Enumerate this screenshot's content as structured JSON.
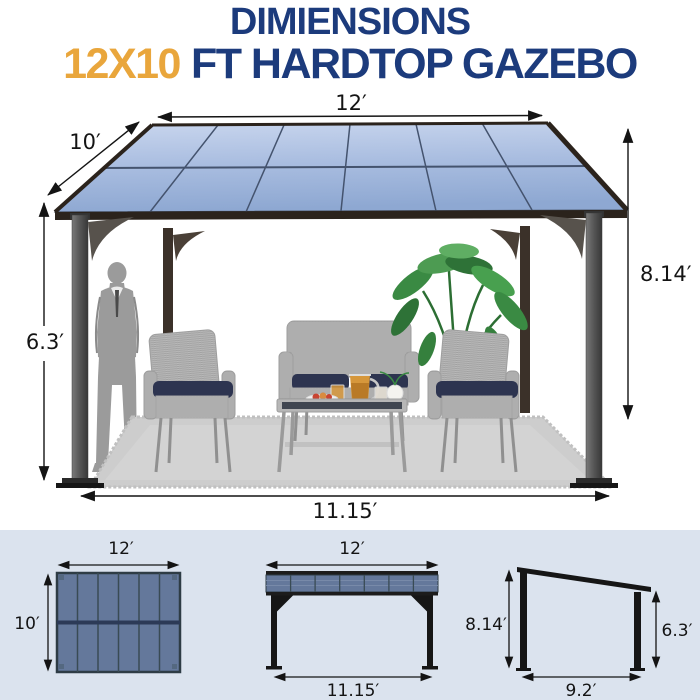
{
  "title": {
    "line1": "DIMIENSIONS",
    "line2_highlight": "12X10",
    "line2_rest": "FT HARDTOP GAZEBO"
  },
  "colors": {
    "title_navy": "#1c3b7c",
    "title_orange": "#e9a63c",
    "footer_background": "#dbe3ee",
    "roof_blue_light": "#c7d5ee",
    "roof_blue_dark": "#8ea8d2",
    "diagram_slate_blue": "#64789b",
    "cushion_navy": "#2d3450",
    "dimension_line": "#141414"
  },
  "main_view": {
    "roof_width": "12′",
    "roof_depth": "10′",
    "post_height_high": "8.14′",
    "post_height_low": "6.3′",
    "base_width": "11.15′"
  },
  "top_view": {
    "width": "12′",
    "depth": "10′"
  },
  "front_view": {
    "roof_width": "12′",
    "base_width": "11.15′"
  },
  "side_view": {
    "height_high": "8.14′",
    "height_low": "6.3′",
    "base_depth": "9.2′"
  }
}
